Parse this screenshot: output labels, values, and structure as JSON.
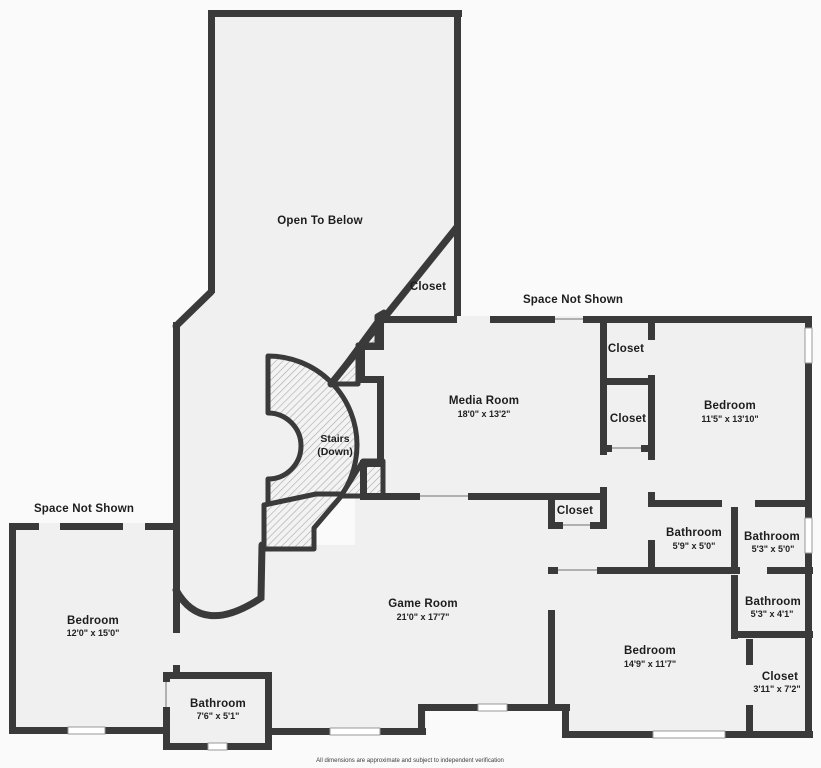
{
  "page": {
    "disclaimer": "All dimensions are approximate and subject to independent verification"
  },
  "colors": {
    "wall": "#3a3a3a",
    "room_fill": "#f0f0f0",
    "background": "#fafafa",
    "hatch_line": "#a8a8a8",
    "window_fill": "#ffffff"
  },
  "areas": {
    "open_to_below": {
      "name": "Open To Below"
    },
    "space_not_shown_top": {
      "name": "Space Not Shown"
    },
    "space_not_shown_left": {
      "name": "Space Not Shown"
    },
    "closet_entry": {
      "name": "Closet"
    },
    "media_room": {
      "name": "Media Room",
      "dims": "18'0\" x 13'2\""
    },
    "closet_1": {
      "name": "Closet"
    },
    "closet_2": {
      "name": "Closet"
    },
    "bedroom_ne": {
      "name": "Bedroom",
      "dims": "11'5\" x 13'10\""
    },
    "stairs": {
      "name": "Stairs",
      "sub": "(Down)"
    },
    "closet_hall": {
      "name": "Closet"
    },
    "bathroom_59": {
      "name": "Bathroom",
      "dims": "5'9\" x 5'0\""
    },
    "bathroom_53_50": {
      "name": "Bathroom",
      "dims": "5'3\" x 5'0\""
    },
    "bedroom_w": {
      "name": "Bedroom",
      "dims": "12'0\" x 15'0\""
    },
    "game_room": {
      "name": "Game Room",
      "dims": "21'0\" x 17'7\""
    },
    "bathroom_53_41": {
      "name": "Bathroom",
      "dims": "5'3\" x 4'1\""
    },
    "bedroom_se": {
      "name": "Bedroom",
      "dims": "14'9\" x 11'7\""
    },
    "closet_se": {
      "name": "Closet",
      "dims": "3'11\" x 7'2\""
    },
    "bathroom_76": {
      "name": "Bathroom",
      "dims": "7'6\" x 5'1\""
    }
  }
}
